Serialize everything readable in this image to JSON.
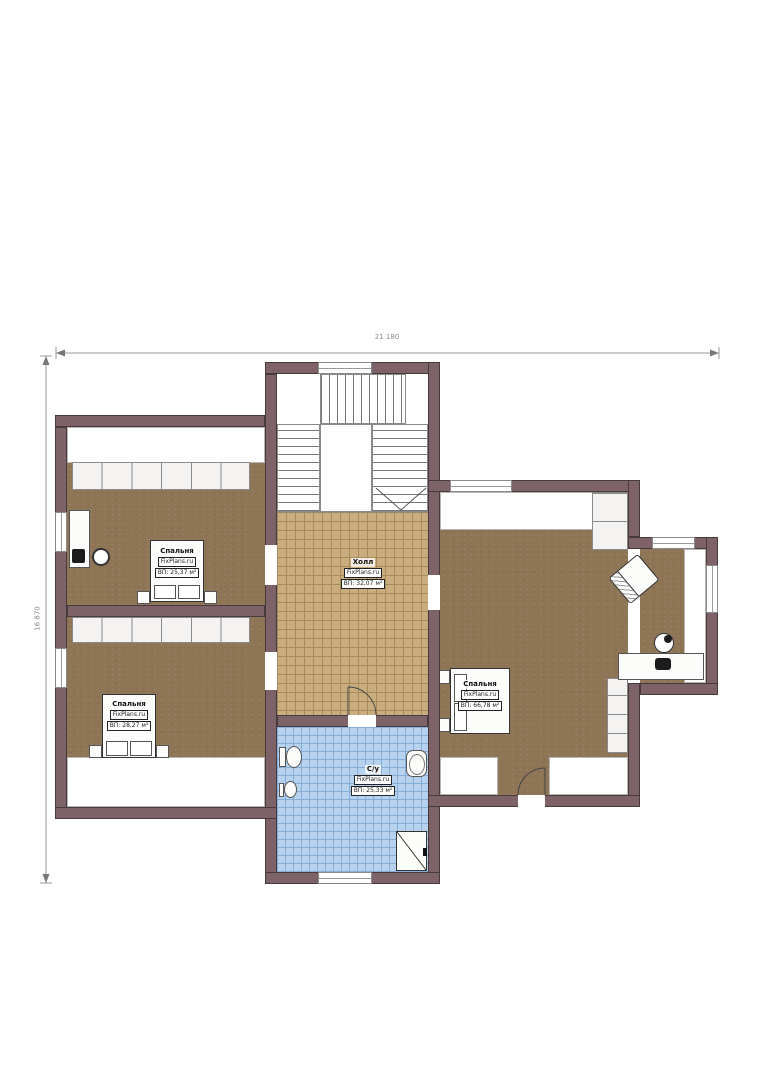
{
  "plan": {
    "dimensions": {
      "top": "21 180",
      "left": "16 870"
    },
    "rooms": [
      {
        "id": "bedroom-top-left",
        "name": "Спальня",
        "brand": "FixPlans.ru",
        "area": "ВП: 25,37 м²"
      },
      {
        "id": "hall",
        "name": "Холл",
        "brand": "FixPlans.ru",
        "area": "ВП: 32,07 м²"
      },
      {
        "id": "bedroom-right",
        "name": "Спальня",
        "brand": "FixPlans.ru",
        "area": "ВП: 66,78 м²"
      },
      {
        "id": "bedroom-bottom-left",
        "name": "Спальня",
        "brand": "FixPlans.ru",
        "area": "ВП: 28,27 м²"
      },
      {
        "id": "bathroom",
        "name": "С/у",
        "brand": "FixPlans.ru",
        "area": "ВП: 25,33 м²"
      }
    ]
  },
  "colors": {
    "wall": "#7d6367",
    "wall_edge": "#473a3e",
    "floor_brown": "#8e7556",
    "hall_tile": "#c9ad7e",
    "hall_tile_line": "#a68a58",
    "bath_tile": "#b7d2ee",
    "bath_tile_line": "#87aed8",
    "fixture_line": "#333333"
  }
}
